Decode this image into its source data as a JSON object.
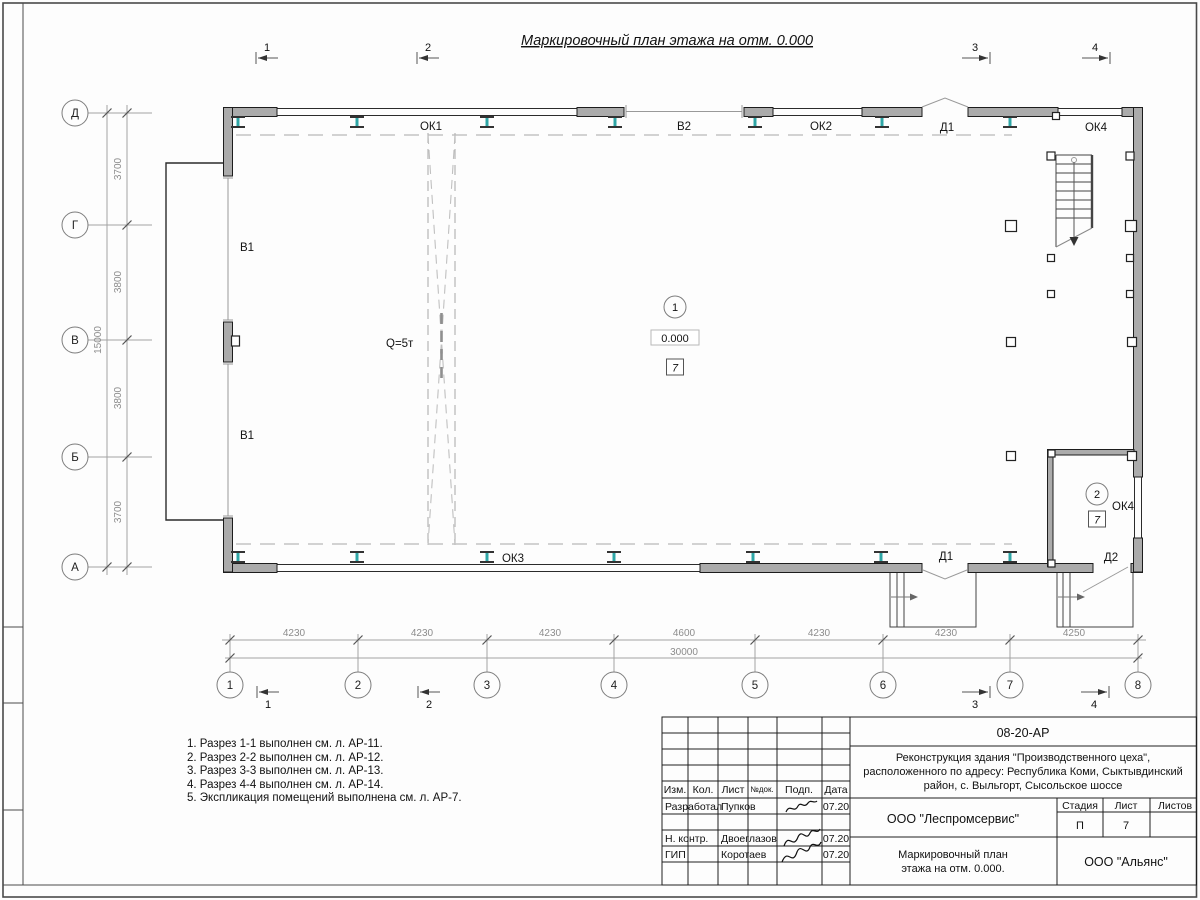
{
  "sheet": {
    "title": "Маркировочный план этажа на отм. 0.000"
  },
  "axes": {
    "vertical": [
      "Д",
      "Г",
      "В",
      "Б",
      "А"
    ],
    "horizontal": [
      "1",
      "2",
      "3",
      "4",
      "5",
      "6",
      "7",
      "8"
    ]
  },
  "sections": {
    "s1": "1",
    "s2": "2",
    "s3": "3",
    "s4": "4"
  },
  "dimensions": {
    "vertical_spans": [
      "3700",
      "3800",
      "3800",
      "3700"
    ],
    "vertical_total": "15000",
    "horizontal_spans": [
      "4230",
      "4230",
      "4230",
      "4600",
      "4230",
      "4230",
      "4250"
    ],
    "horizontal_total": "30000"
  },
  "plan_labels": {
    "ok1": "ОК1",
    "v2": "В2",
    "ok2": "ОК2",
    "d1_top": "Д1",
    "ok4_top": "ОК4",
    "v1_upper": "В1",
    "v1_lower": "В1",
    "crane_capacity": "Q=5т",
    "ok3": "ОК3",
    "d1_bottom": "Д1",
    "d2": "Д2",
    "ok4_room": "ОК4"
  },
  "rooms": {
    "room1": {
      "number": "1",
      "elevation": "0.000",
      "finish": "7"
    },
    "room2": {
      "number": "2",
      "finish": "7"
    }
  },
  "notes": [
    "1. Разрез 1-1 выполнен см. л. АР-11.",
    "2. Разрез 2-2 выполнен см. л. АР-12.",
    "3. Разрез 3-3 выполнен см. л. АР-13.",
    "4. Разрез 4-4 выполнен см. л. АР-14.",
    "5. Экспликация помещений выполнена см. л. АР-7."
  ],
  "title_block": {
    "doc_number": "08-20-АР",
    "project_line1": "Реконструкция здания \"Производственного цеха\",",
    "project_line2": "расположенного по адресу: Республика Коми, Сыктывдинский",
    "project_line3": "район, с. Выльгорт, Сысольское шоссе",
    "columns": {
      "izm": "Изм.",
      "kol": "Кол.",
      "list": "Лист",
      "ndok": "№док.",
      "podp": "Подп.",
      "data": "Дата"
    },
    "stage_header": {
      "stage": "Стадия",
      "sheet": "Лист",
      "sheets": "Листов"
    },
    "stage_value": "П",
    "sheet_value": "7",
    "org": "ООО \"Леспромсервис\"",
    "drawing_title_line1": "Маркировочный план",
    "drawing_title_line2": "этажа на отм. 0.000.",
    "company": "ООО \"Альянс\"",
    "roles": [
      {
        "role": "Разработал",
        "name": "Пупков",
        "date": "07.20"
      },
      {
        "role": "Н. контр.",
        "name": "Двоеглазов",
        "date": "07.20"
      },
      {
        "role": "ГИП",
        "name": "Коротаев",
        "date": "07.20"
      }
    ]
  }
}
